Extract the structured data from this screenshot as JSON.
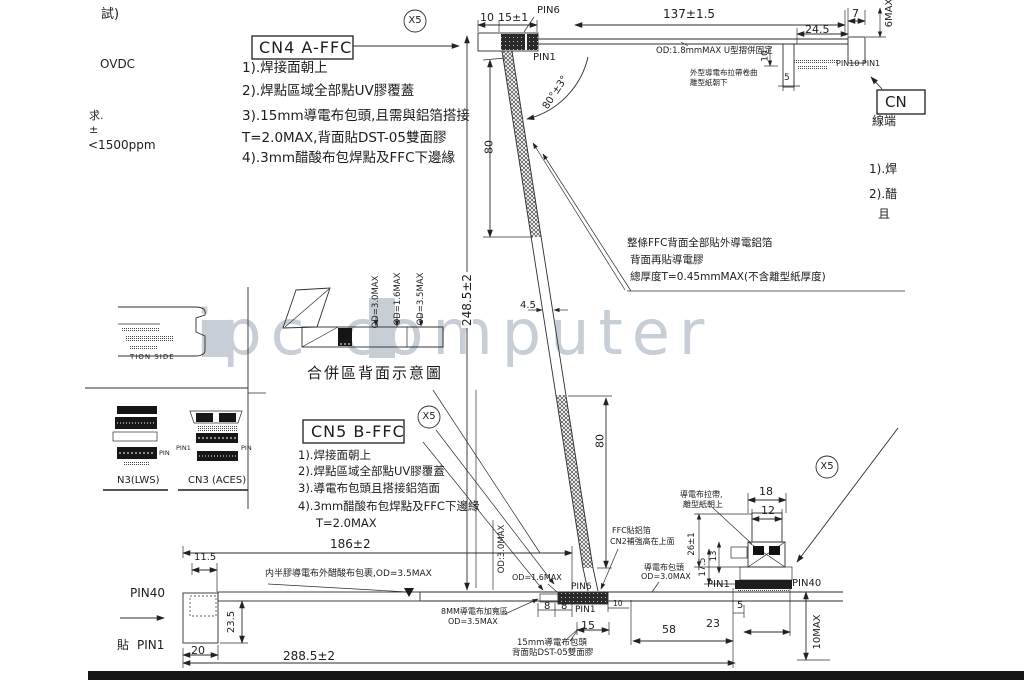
{
  "fragments": {
    "f1": "試)",
    "f2": "OVDC",
    "f3": "求.",
    "f4": "±",
    "f5": "<1500ppm"
  },
  "watermark": {
    "text": "ipc computer"
  },
  "x5": "X5",
  "cn4": {
    "title": "CN4 A-FFC",
    "n1": "1).焊接面朝上",
    "n2": "2).焊點區域全部點UV膠覆蓋",
    "n3": "3).15mm導電布包頭,且需與鋁箔搭接",
    "n3b": "T=2.0MAX,背面貼DST-05雙面膠",
    "n4": "4).3mm醋酸布包焊點及FFC下邊緣"
  },
  "cn5": {
    "title": "CN5 B-FFC",
    "n1": "1).焊接面朝上",
    "n2": "2).焊點區域全部點UV膠覆蓋",
    "n3": "3).導電布包頭且搭接鋁箔面",
    "n4": "4).3mm醋酸布包焊點及FFC下邊緣",
    "n4b": "T=2.0MAX"
  },
  "top": {
    "d10": "10",
    "d15": "15±1",
    "pin6": "PIN6",
    "pin1": "PIN1",
    "d137": "137±1.5",
    "od18": "OD:1.8mmMAX U型摺併固定",
    "tape1": "外型導電布拉帶卷曲",
    "tape2": "離型紙朝下",
    "d10b": "10",
    "d5": "5",
    "pins": "PIN10  PIN1",
    "d245": "24.5",
    "d7": "7",
    "d6max": "6MAX"
  },
  "rightcol": {
    "cn": "CN",
    "line_end": "線端",
    "n1": "1).焊",
    "n2": "2).醋",
    "n3": "且"
  },
  "mid": {
    "f1": "整條FFC背面全部貼外導電鋁箔",
    "f2": "背面再貼導電膠",
    "f3": "總厚度T=0.45mmMAX(不含離型紙厚度)",
    "d80a": "80",
    "angle": "80°±3°",
    "d45": "4.5",
    "d80b": "80",
    "d2485": "248.5±2"
  },
  "merge": {
    "od30": "OD=3.0MAX",
    "od16": "OD=1.6MAX",
    "od35": "OD=3.5MAX",
    "caption": "合併區背面示意圖"
  },
  "bottom": {
    "pin40": "PIN40",
    "tie": "貼",
    "pin1": "PIN1",
    "d115": "11.5",
    "d235": "23.5",
    "d20": "20",
    "d186": "186±2",
    "wrap": "内半膠導電布外醋酸布包裹,OD=3.5MAX",
    "d2885": "288.5±2",
    "od30": "OD:3.0MAX",
    "od16": "OD=1.6MAX",
    "pin6": "PIN6",
    "pin1b": "PIN1",
    "d8a": "8",
    "d8b": "8",
    "d10": "10",
    "d15": "15",
    "d58": "58",
    "widen1": "8MM導電布加寬區",
    "widen2": "OD=3.5MAX",
    "head1": "15mm導電布包頭",
    "head2": "背面貼DST-05雙面膠",
    "ffc1": "FFC貼鋁箔",
    "ffc2": "CN2補強高在上面",
    "cover1": "導電布包頭",
    "cover2": "OD=3.0MAX",
    "d5": "5",
    "d23": "23",
    "d10max": "10MAX"
  },
  "rconn": {
    "tape1": "導電布拉帶,",
    "tape2": "離型紙朝上",
    "d18": "18",
    "d12": "12",
    "d26": "26±1",
    "d175": "17.5",
    "d13": "13",
    "pin1": "PIN1",
    "pin40": "PIN40"
  },
  "leftpanel": {
    "side": "TION SIDE",
    "pin": "PIN",
    "pin1": "PIN1",
    "lws": "N3(LWS)",
    "aces": "CN3 (ACES)"
  }
}
